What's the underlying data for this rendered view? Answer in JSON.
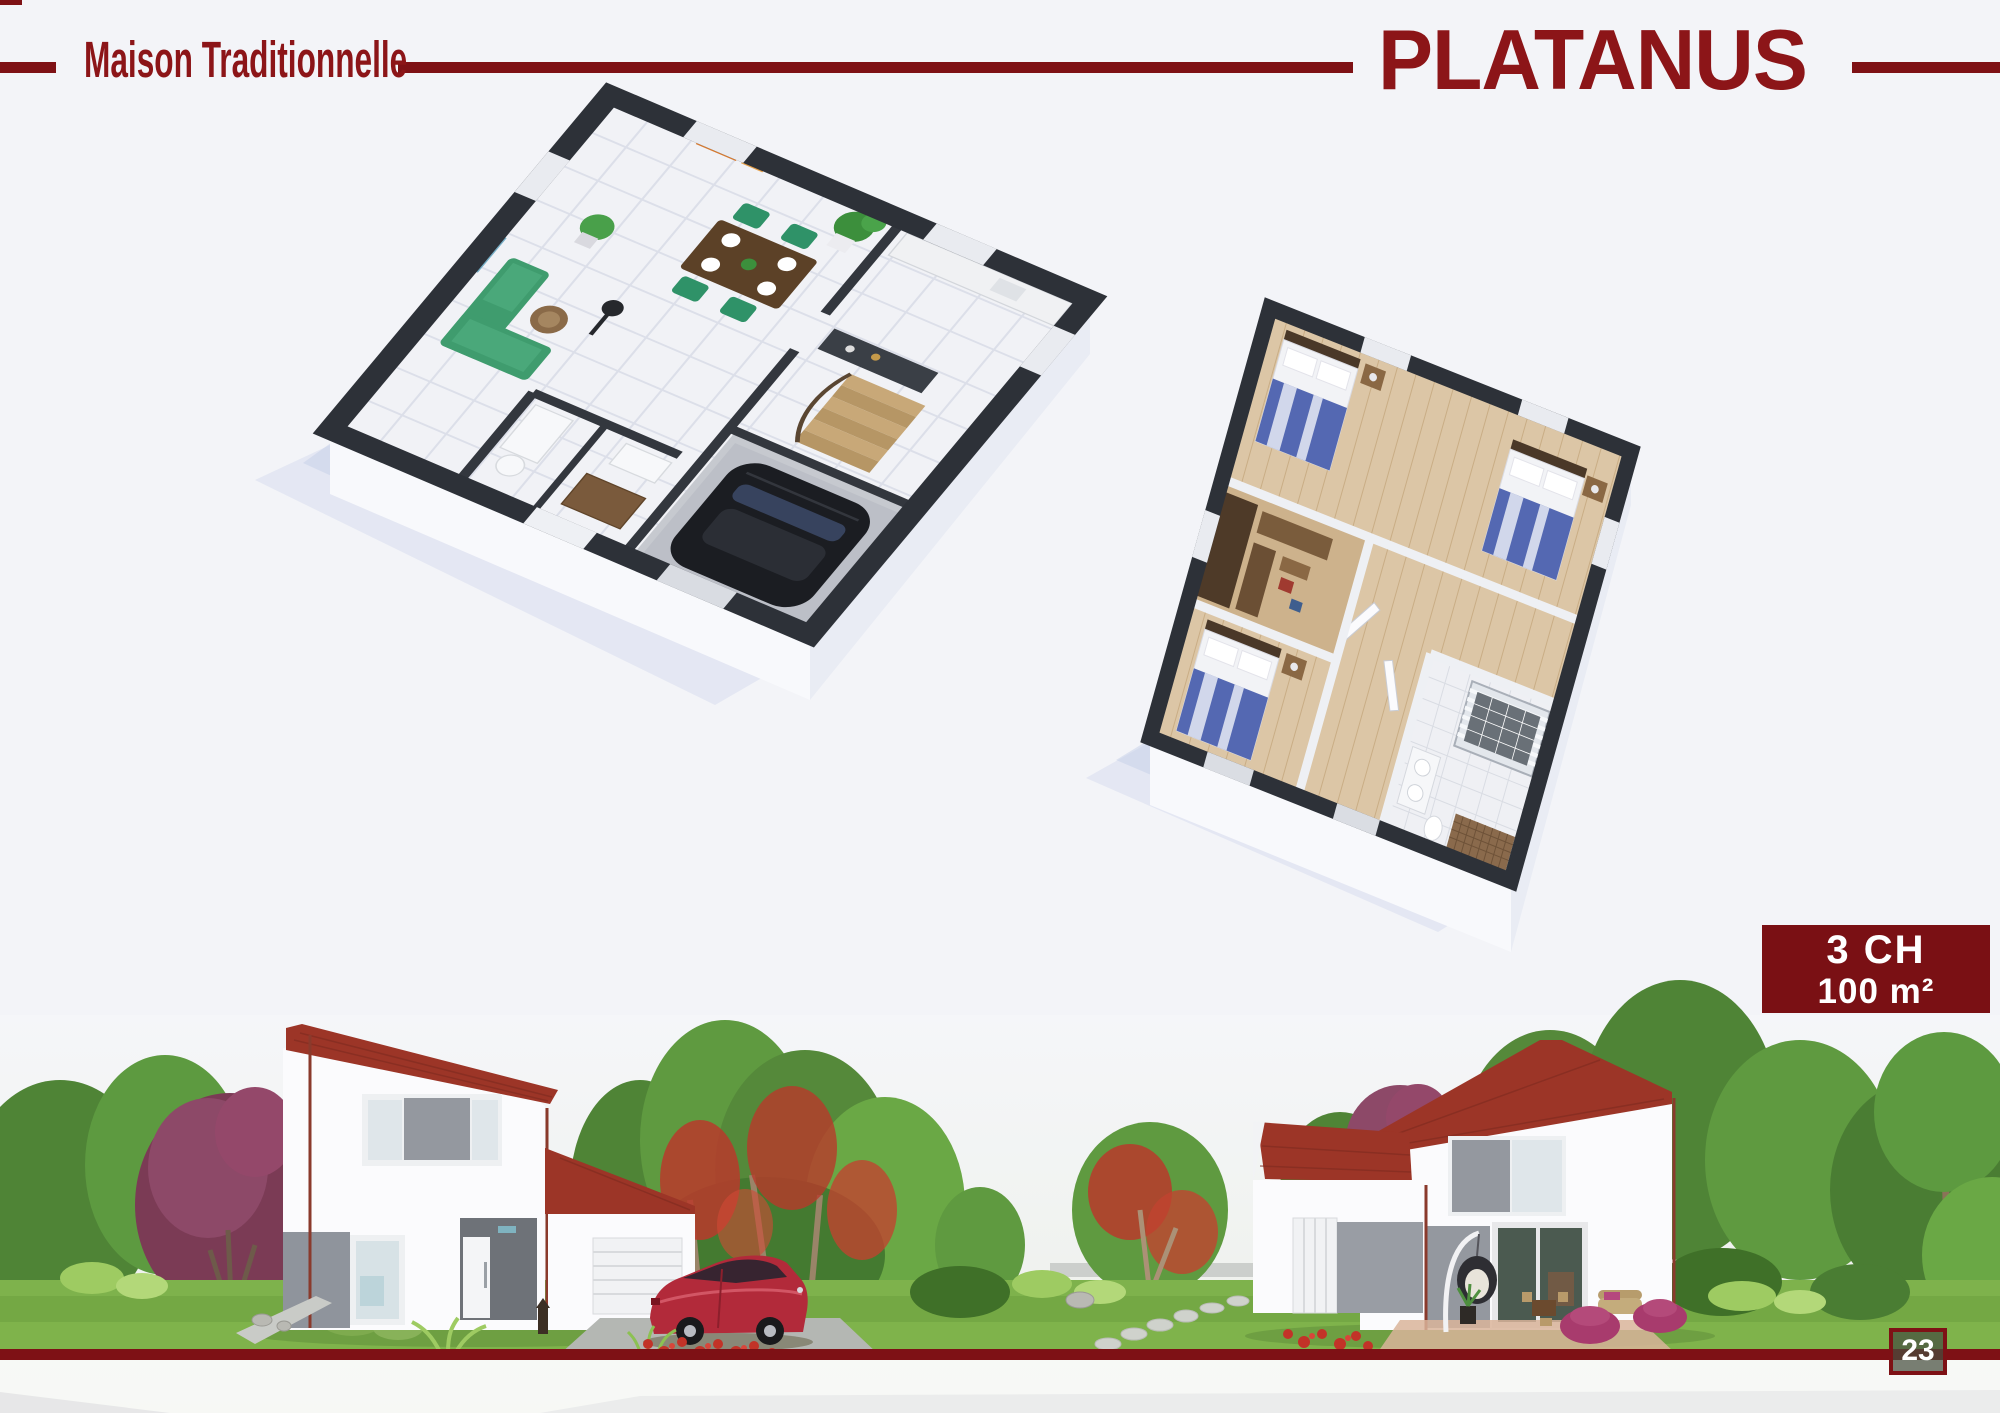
{
  "page": {
    "background": "#f3f4f8"
  },
  "header": {
    "series_label": "Maison Traditionnelle",
    "model_name": "PLATANUS",
    "accent_color": "#7e1115",
    "title_color": "#8c1518"
  },
  "spec_badge": {
    "bedrooms": "3 CH",
    "area": "100 m²",
    "background": "#7a1014",
    "text_color": "#ffffff"
  },
  "footer": {
    "page_number": "23",
    "bar_color": "#7e1115"
  },
  "floor_plans": [
    {
      "name": "ground-floor-3d-plan"
    },
    {
      "name": "upper-floor-3d-plan"
    }
  ],
  "scene": {
    "name": "exterior-garden-render"
  }
}
